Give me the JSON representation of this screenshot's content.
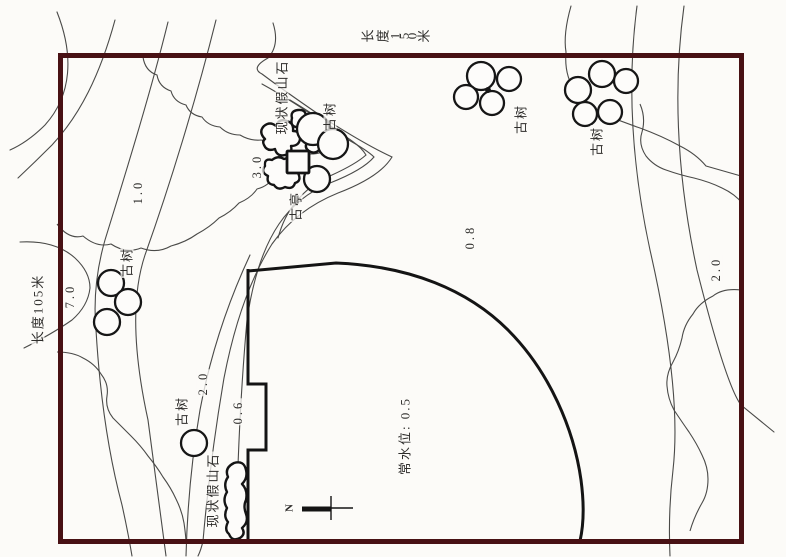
{
  "drawing": {
    "type": "garden site survey plan",
    "colors": {
      "border": "#481114",
      "contour_line": "#4a4a48",
      "ink": "#151515",
      "label_text": "#2e2d2b",
      "background": "#fcfbf8"
    },
    "dimensions": {
      "top": "长度150米",
      "left": "长度105米"
    },
    "contour_labels": [
      {
        "id": "elev-1-0",
        "text": "1.0"
      },
      {
        "id": "elev-3-0",
        "text": "3.0"
      },
      {
        "id": "elev-7-0",
        "text": "7.0"
      },
      {
        "id": "elev-2-0-left",
        "text": "2.0"
      },
      {
        "id": "elev-0-6",
        "text": "0.6"
      },
      {
        "id": "elev-0-8",
        "text": "0.8"
      },
      {
        "id": "elev-2-0-right",
        "text": "2.0"
      }
    ],
    "feature_labels": [
      {
        "id": "rockery-top",
        "text": "现状假山石"
      },
      {
        "id": "tree-pavilion",
        "text": "古树"
      },
      {
        "id": "pavilion",
        "text": "古亭"
      },
      {
        "id": "tree-top-middle",
        "text": "古树"
      },
      {
        "id": "tree-top-right",
        "text": "古树"
      },
      {
        "id": "tree-left",
        "text": "古树"
      },
      {
        "id": "tree-bottom",
        "text": "古树"
      },
      {
        "id": "rockery-bottom",
        "text": "现状假山石"
      },
      {
        "id": "water-level",
        "text": "常水位: 0.5"
      }
    ],
    "north_arrow": {
      "label": "N"
    }
  }
}
